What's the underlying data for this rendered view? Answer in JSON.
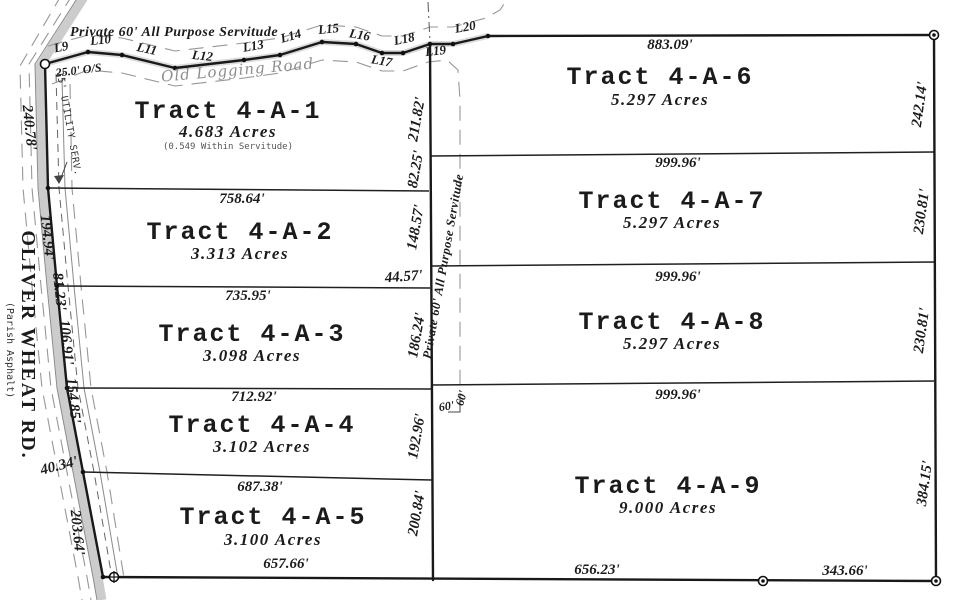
{
  "meta": {
    "background": "#ffffff",
    "ink": "#1b1b1b",
    "road_fill": "#c6c6c6",
    "muted_gray": "#8e8e8e"
  },
  "tracts": [
    {
      "name": "Tract 4-A-1",
      "acres": "4.683 Acres",
      "note": "(0.549 Within Servitude)"
    },
    {
      "name": "Tract 4-A-2",
      "acres": "3.313 Acres"
    },
    {
      "name": "Tract 4-A-3",
      "acres": "3.098 Acres"
    },
    {
      "name": "Tract 4-A-4",
      "acres": "3.102 Acres"
    },
    {
      "name": "Tract 4-A-5",
      "acres": "3.100 Acres"
    },
    {
      "name": "Tract 4-A-6",
      "acres": "5.297 Acres"
    },
    {
      "name": "Tract 4-A-7",
      "acres": "5.297 Acres"
    },
    {
      "name": "Tract 4-A-8",
      "acres": "5.297 Acres"
    },
    {
      "name": "Tract 4-A-9",
      "acres": "9.000 Acres"
    }
  ],
  "labels": [
    {
      "n": "tract-4a1-title",
      "t": "Tract 4-A-1",
      "x": 228,
      "y": 118,
      "r": 0,
      "c": "title"
    },
    {
      "n": "tract-4a1-acres",
      "t": "4.683 Acres",
      "x": 228,
      "y": 137,
      "r": 0,
      "c": "acres"
    },
    {
      "n": "tract-4a1-note",
      "t": "(0.549 Within Servitude)",
      "x": 228,
      "y": 149,
      "r": 0,
      "c": "note"
    },
    {
      "n": "tract-4a2-title",
      "t": "Tract 4-A-2",
      "x": 240,
      "y": 239,
      "r": 0,
      "c": "title"
    },
    {
      "n": "tract-4a2-acres",
      "t": "3.313 Acres",
      "x": 240,
      "y": 259,
      "r": 0,
      "c": "acres"
    },
    {
      "n": "tract-4a3-title",
      "t": "Tract 4-A-3",
      "x": 252,
      "y": 341,
      "r": 0,
      "c": "title"
    },
    {
      "n": "tract-4a3-acres",
      "t": "3.098 Acres",
      "x": 252,
      "y": 361,
      "r": 0,
      "c": "acres"
    },
    {
      "n": "tract-4a4-title",
      "t": "Tract 4-A-4",
      "x": 262,
      "y": 432,
      "r": 0,
      "c": "title"
    },
    {
      "n": "tract-4a4-acres",
      "t": "3.102 Acres",
      "x": 262,
      "y": 452,
      "r": 0,
      "c": "acres"
    },
    {
      "n": "tract-4a5-title",
      "t": "Tract 4-A-5",
      "x": 273,
      "y": 524,
      "r": 0,
      "c": "title"
    },
    {
      "n": "tract-4a5-acres",
      "t": "3.100 Acres",
      "x": 273,
      "y": 545,
      "r": 0,
      "c": "acres"
    },
    {
      "n": "tract-4a6-title",
      "t": "Tract 4-A-6",
      "x": 660,
      "y": 84,
      "r": 0,
      "c": "title"
    },
    {
      "n": "tract-4a6-acres",
      "t": "5.297 Acres",
      "x": 660,
      "y": 105,
      "r": 0,
      "c": "acres"
    },
    {
      "n": "tract-4a7-title",
      "t": "Tract 4-A-7",
      "x": 672,
      "y": 208,
      "r": 0,
      "c": "title"
    },
    {
      "n": "tract-4a7-acres",
      "t": "5.297 Acres",
      "x": 672,
      "y": 228,
      "r": 0,
      "c": "acres"
    },
    {
      "n": "tract-4a8-title",
      "t": "Tract 4-A-8",
      "x": 672,
      "y": 329,
      "r": 0,
      "c": "title"
    },
    {
      "n": "tract-4a8-acres",
      "t": "5.297 Acres",
      "x": 672,
      "y": 349,
      "r": 0,
      "c": "acres"
    },
    {
      "n": "tract-4a9-title",
      "t": "Tract 4-A-9",
      "x": 668,
      "y": 493,
      "r": 0,
      "c": "title"
    },
    {
      "n": "tract-4a9-acres",
      "t": "9.000 Acres",
      "x": 668,
      "y": 513,
      "r": 0,
      "c": "acres"
    },
    {
      "n": "dim-883-09",
      "t": "883.09'",
      "x": 670,
      "y": 49,
      "r": 0,
      "c": "dim"
    },
    {
      "n": "dim-999-96-a",
      "t": "999.96'",
      "x": 678,
      "y": 167,
      "r": 0,
      "c": "dim"
    },
    {
      "n": "dim-999-96-b",
      "t": "999.96'",
      "x": 678,
      "y": 281,
      "r": 0,
      "c": "dim"
    },
    {
      "n": "dim-999-96-c",
      "t": "999.96'",
      "x": 678,
      "y": 399,
      "r": 0,
      "c": "dim"
    },
    {
      "n": "dim-758-64",
      "t": "758.64'",
      "x": 242,
      "y": 203,
      "r": 0,
      "c": "dim"
    },
    {
      "n": "dim-735-95",
      "t": "735.95'",
      "x": 248,
      "y": 300,
      "r": 0,
      "c": "dim"
    },
    {
      "n": "dim-712-92",
      "t": "712.92'",
      "x": 254,
      "y": 401,
      "r": 0,
      "c": "dim"
    },
    {
      "n": "dim-687-38",
      "t": "687.38'",
      "x": 260,
      "y": 491,
      "r": 0,
      "c": "dim"
    },
    {
      "n": "dim-657-66",
      "t": "657.66'",
      "x": 286,
      "y": 568,
      "r": 0,
      "c": "dim"
    },
    {
      "n": "dim-656-23",
      "t": "656.23'",
      "x": 597,
      "y": 574,
      "r": 0,
      "c": "dim"
    },
    {
      "n": "dim-343-66",
      "t": "343.66'",
      "x": 845,
      "y": 575,
      "r": 0,
      "c": "dim"
    },
    {
      "n": "dim-44-57",
      "t": "44.57'",
      "x": 404,
      "y": 281,
      "r": -4,
      "c": "dim"
    },
    {
      "n": "dim-40-34",
      "t": "40.34'",
      "x": 60,
      "y": 470,
      "r": -14,
      "c": "dim"
    },
    {
      "n": "dim-25-0-os",
      "t": "25.0' O/S",
      "x": 79,
      "y": 74,
      "r": -7,
      "c": "dimsm"
    },
    {
      "n": "dim-211-82",
      "t": "211.82'",
      "x": 421,
      "y": 120,
      "r": -80,
      "c": "dim"
    },
    {
      "n": "dim-82-25",
      "t": "82.25'",
      "x": 420,
      "y": 170,
      "r": -80,
      "c": "dim"
    },
    {
      "n": "dim-148-57",
      "t": "148.57'",
      "x": 420,
      "y": 228,
      "r": -80,
      "c": "dim"
    },
    {
      "n": "dim-186-24",
      "t": "186.24'",
      "x": 421,
      "y": 336,
      "r": -80,
      "c": "dim"
    },
    {
      "n": "dim-192-96",
      "t": "192.96'",
      "x": 421,
      "y": 437,
      "r": -80,
      "c": "dim"
    },
    {
      "n": "dim-200-84",
      "t": "200.84'",
      "x": 421,
      "y": 514,
      "r": -80,
      "c": "dim"
    },
    {
      "n": "dim-242-14",
      "t": "242.14'",
      "x": 924,
      "y": 105,
      "r": -82,
      "c": "dim"
    },
    {
      "n": "dim-230-81-a",
      "t": "230.81'",
      "x": 926,
      "y": 212,
      "r": -82,
      "c": "dim"
    },
    {
      "n": "dim-230-81-b",
      "t": "230.81'",
      "x": 926,
      "y": 331,
      "r": -82,
      "c": "dim"
    },
    {
      "n": "dim-384-15",
      "t": "384.15'",
      "x": 929,
      "y": 484,
      "r": -82,
      "c": "dim"
    },
    {
      "n": "dim-240-78",
      "t": "240.78'",
      "x": 25,
      "y": 128,
      "r": 84,
      "c": "dim"
    },
    {
      "n": "dim-194-94",
      "t": "194.94'",
      "x": 43,
      "y": 238,
      "r": 84,
      "c": "dim"
    },
    {
      "n": "dim-81-23",
      "t": "81.23'",
      "x": 55,
      "y": 292,
      "r": 84,
      "c": "dim"
    },
    {
      "n": "dim-106-91",
      "t": "106.91'",
      "x": 62,
      "y": 343,
      "r": 84,
      "c": "dim"
    },
    {
      "n": "dim-154-85",
      "t": "154.85'",
      "x": 69,
      "y": 401,
      "r": 84,
      "c": "dim"
    },
    {
      "n": "dim-203-64",
      "t": "203.64'",
      "x": 73,
      "y": 533,
      "r": 84,
      "c": "dim"
    },
    {
      "n": "dim-60-a",
      "t": "60'",
      "x": 447,
      "y": 410,
      "r": -8,
      "c": "dimsm"
    },
    {
      "n": "dim-60-b",
      "t": "60'",
      "x": 465,
      "y": 399,
      "r": -75,
      "c": "dimsm"
    },
    {
      "n": "line-label-l9",
      "t": "L9",
      "x": 62,
      "y": 51,
      "r": -12,
      "c": "llab"
    },
    {
      "n": "line-label-l10",
      "t": "L10",
      "x": 101,
      "y": 44,
      "r": -6,
      "c": "llab"
    },
    {
      "n": "line-label-l11",
      "t": "L11",
      "x": 146,
      "y": 53,
      "r": 12,
      "c": "llab"
    },
    {
      "n": "line-label-l12",
      "t": "L12",
      "x": 202,
      "y": 60,
      "r": 6,
      "c": "llab"
    },
    {
      "n": "line-label-l13",
      "t": "L13",
      "x": 254,
      "y": 50,
      "r": -10,
      "c": "llab"
    },
    {
      "n": "line-label-l14",
      "t": "L14",
      "x": 292,
      "y": 40,
      "r": -16,
      "c": "llab"
    },
    {
      "n": "line-label-l15",
      "t": "L15",
      "x": 329,
      "y": 33,
      "r": -6,
      "c": "llab"
    },
    {
      "n": "line-label-l16",
      "t": "L16",
      "x": 359,
      "y": 39,
      "r": 10,
      "c": "llab"
    },
    {
      "n": "line-label-l17",
      "t": "L17",
      "x": 381,
      "y": 65,
      "r": 10,
      "c": "llab"
    },
    {
      "n": "line-label-l18",
      "t": "L18",
      "x": 405,
      "y": 43,
      "r": -12,
      "c": "llab"
    },
    {
      "n": "line-label-l19",
      "t": "L19",
      "x": 436,
      "y": 55,
      "r": -6,
      "c": "llab"
    },
    {
      "n": "line-label-l20",
      "t": "L20",
      "x": 466,
      "y": 31,
      "r": -10,
      "c": "llab"
    },
    {
      "n": "servitude-heading",
      "t": "Private 60' All Purpose Servitude",
      "x": 174,
      "y": 36,
      "r": 0,
      "c": "servhead"
    },
    {
      "n": "old-logging-road-label",
      "t": "Old Logging Road",
      "x": 238,
      "y": 75,
      "r": -5,
      "c": "logroad"
    },
    {
      "n": "servitude-mid-label",
      "t": "Private 60' All Purpose Servitude",
      "x": 447,
      "y": 267,
      "r": -80,
      "c": "servmid"
    },
    {
      "n": "utility-serv-label",
      "t": "15' UTILITY SERV.",
      "x": 66,
      "y": 124,
      "r": 80,
      "c": "util"
    },
    {
      "n": "road-name",
      "t": "OLIVER WHEAT RD.",
      "x": 22,
      "y": 345,
      "r": 90,
      "c": "road"
    },
    {
      "n": "road-surface",
      "t": "(Parish Asphalt)",
      "x": 7,
      "y": 350,
      "r": 90,
      "c": "parish"
    }
  ]
}
